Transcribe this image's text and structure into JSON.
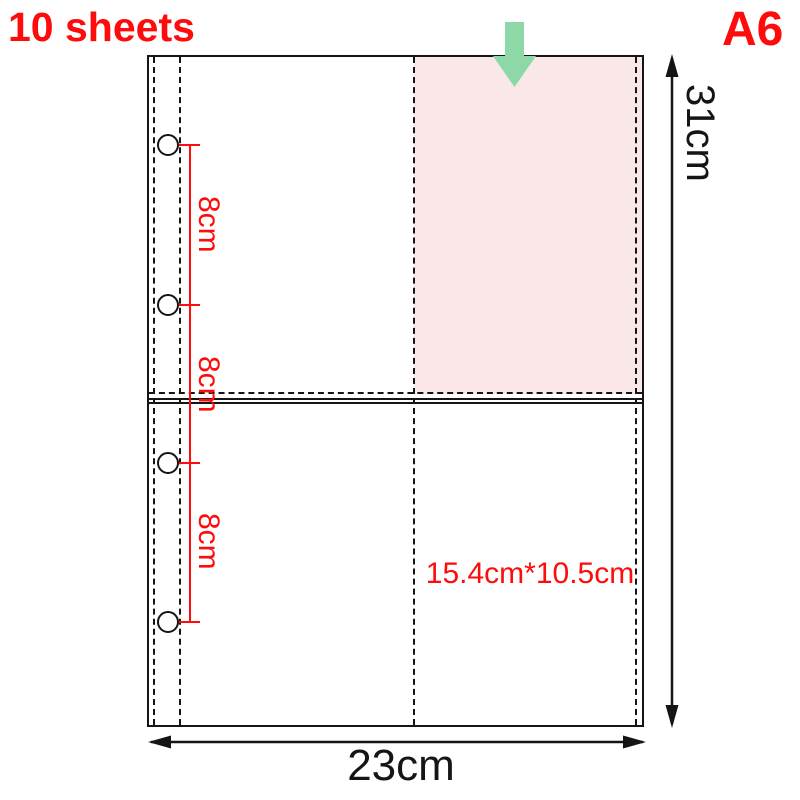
{
  "header": {
    "sheet_count": "10 sheets",
    "size_badge": "A6"
  },
  "diagram": {
    "height_label": "31cm",
    "width_label": "23cm",
    "pocket_size_label": "15.4cm*10.5cm",
    "hole_spacing_labels": [
      "8cm",
      "8cm",
      "8cm"
    ]
  },
  "colors": {
    "accent_red": "#ff0b0b",
    "arrow_green": "#8dd8a6",
    "pocket_pink": "#fae7e8",
    "line_black": "#151515"
  }
}
